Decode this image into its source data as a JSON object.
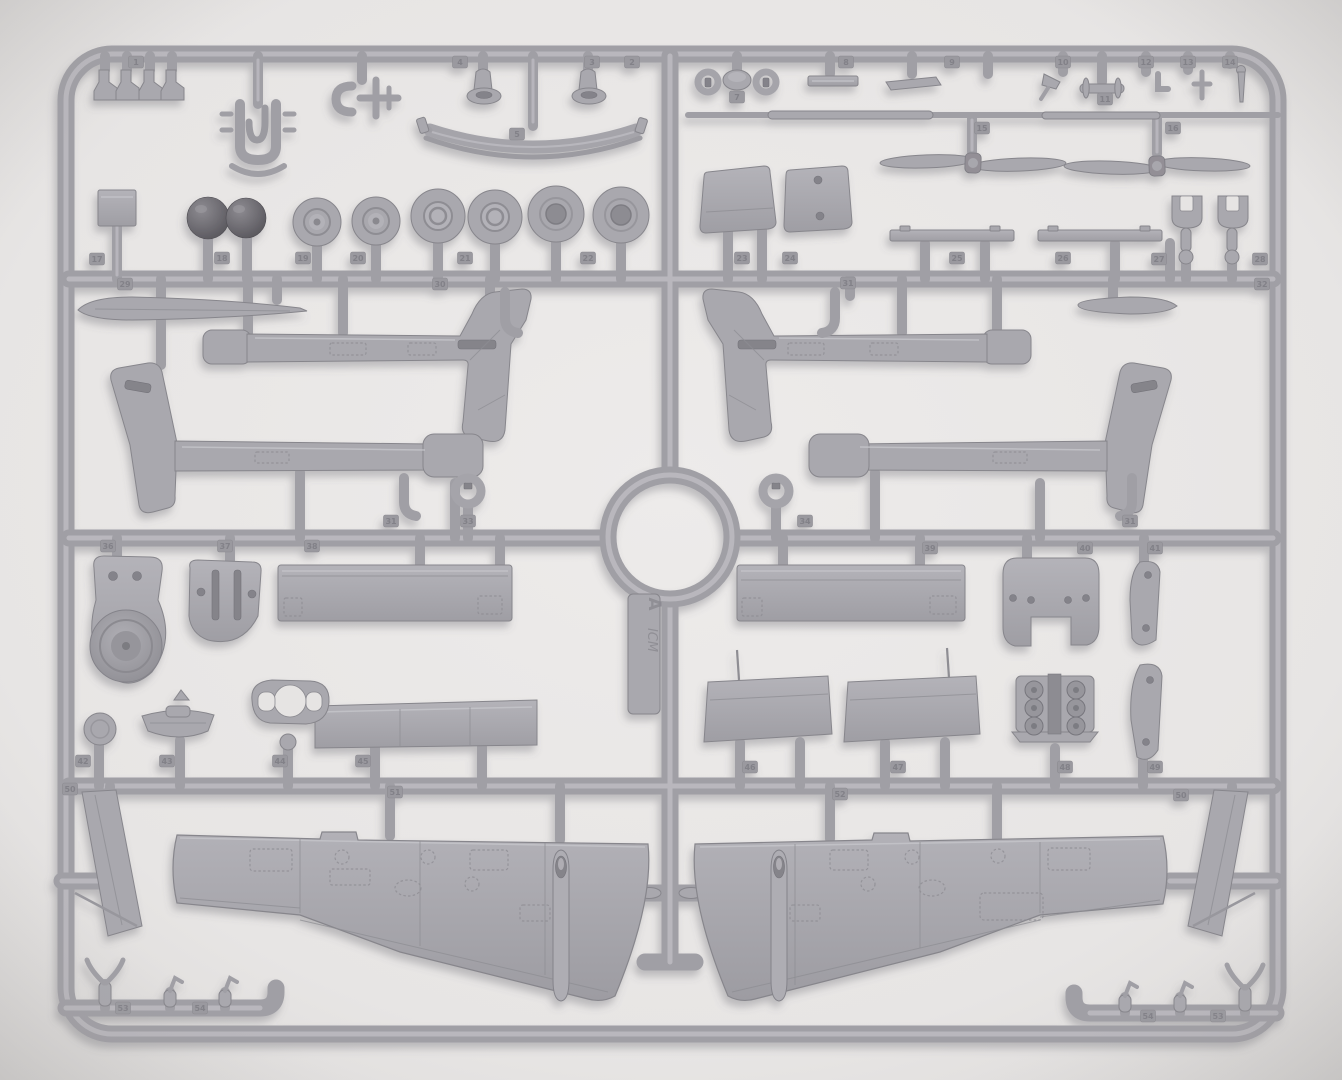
{
  "sprue": {
    "brand": "ICM",
    "letter": "A"
  },
  "colors": {
    "background": "#e9e7e6",
    "vignette": "#c9c7c5",
    "plastic_runner": "#a09fa5",
    "plastic_part": "#a9a8ae",
    "plastic_highlight": "#c3c2c8",
    "plastic_shadow_line": "#87868c",
    "dark_sphere": "#5e5c62",
    "tag_plate": "#9a999f",
    "shadow": "rgba(96,94,102,0.35)"
  },
  "part_number_tags": [
    {
      "n": "1",
      "x": 136,
      "y": 62
    },
    {
      "n": "2",
      "x": 632,
      "y": 62
    },
    {
      "n": "4",
      "x": 460,
      "y": 62
    },
    {
      "n": "3",
      "x": 592,
      "y": 62
    },
    {
      "n": "5",
      "x": 517,
      "y": 134
    },
    {
      "n": "7",
      "x": 737,
      "y": 97
    },
    {
      "n": "8",
      "x": 846,
      "y": 62
    },
    {
      "n": "9",
      "x": 952,
      "y": 62
    },
    {
      "n": "10",
      "x": 1063,
      "y": 62
    },
    {
      "n": "11",
      "x": 1105,
      "y": 99
    },
    {
      "n": "12",
      "x": 1146,
      "y": 62
    },
    {
      "n": "13",
      "x": 1188,
      "y": 62
    },
    {
      "n": "14",
      "x": 1230,
      "y": 62
    },
    {
      "n": "15",
      "x": 982,
      "y": 128
    },
    {
      "n": "16",
      "x": 1173,
      "y": 128
    },
    {
      "n": "17",
      "x": 97,
      "y": 259
    },
    {
      "n": "18",
      "x": 222,
      "y": 258
    },
    {
      "n": "19",
      "x": 303,
      "y": 258
    },
    {
      "n": "20",
      "x": 358,
      "y": 258
    },
    {
      "n": "21",
      "x": 465,
      "y": 258
    },
    {
      "n": "22",
      "x": 588,
      "y": 258
    },
    {
      "n": "23",
      "x": 742,
      "y": 258
    },
    {
      "n": "24",
      "x": 790,
      "y": 258
    },
    {
      "n": "25",
      "x": 957,
      "y": 258
    },
    {
      "n": "26",
      "x": 1063,
      "y": 258
    },
    {
      "n": "27",
      "x": 1159,
      "y": 259
    },
    {
      "n": "28",
      "x": 1260,
      "y": 259
    },
    {
      "n": "29",
      "x": 125,
      "y": 284
    },
    {
      "n": "30",
      "x": 440,
      "y": 284
    },
    {
      "n": "31",
      "x": 848,
      "y": 283
    },
    {
      "n": "32",
      "x": 1262,
      "y": 284
    },
    {
      "n": "31",
      "x": 391,
      "y": 521
    },
    {
      "n": "31",
      "x": 1130,
      "y": 521
    },
    {
      "n": "33",
      "x": 468,
      "y": 521
    },
    {
      "n": "34",
      "x": 805,
      "y": 521
    },
    {
      "n": "36",
      "x": 108,
      "y": 546
    },
    {
      "n": "37",
      "x": 225,
      "y": 546
    },
    {
      "n": "38",
      "x": 312,
      "y": 546
    },
    {
      "n": "39",
      "x": 930,
      "y": 548
    },
    {
      "n": "40",
      "x": 1085,
      "y": 548
    },
    {
      "n": "41",
      "x": 1155,
      "y": 548
    },
    {
      "n": "42",
      "x": 83,
      "y": 761
    },
    {
      "n": "43",
      "x": 167,
      "y": 761
    },
    {
      "n": "44",
      "x": 280,
      "y": 761
    },
    {
      "n": "45",
      "x": 363,
      "y": 761
    },
    {
      "n": "46",
      "x": 750,
      "y": 767
    },
    {
      "n": "47",
      "x": 898,
      "y": 767
    },
    {
      "n": "48",
      "x": 1065,
      "y": 767
    },
    {
      "n": "49",
      "x": 1155,
      "y": 767
    },
    {
      "n": "50",
      "x": 70,
      "y": 789
    },
    {
      "n": "51",
      "x": 395,
      "y": 792
    },
    {
      "n": "52",
      "x": 840,
      "y": 794
    },
    {
      "n": "50",
      "x": 1181,
      "y": 795
    },
    {
      "n": "53",
      "x": 123,
      "y": 1008
    },
    {
      "n": "54",
      "x": 200,
      "y": 1008
    },
    {
      "n": "54",
      "x": 1148,
      "y": 1016
    },
    {
      "n": "53",
      "x": 1218,
      "y": 1016
    }
  ]
}
